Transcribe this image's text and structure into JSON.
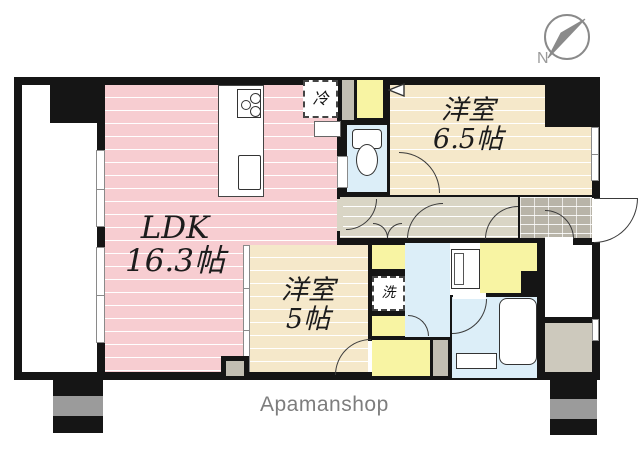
{
  "brand": "Apamanshop",
  "compass": {
    "label": "N"
  },
  "rooms": {
    "ldk": {
      "name": "LDK",
      "size": "16.3帖"
    },
    "bedroom_65": {
      "name": "洋室",
      "size": "6.5帖"
    },
    "bedroom_5": {
      "name": "洋室",
      "size": "5帖"
    }
  },
  "fixtures": {
    "refrigerator": "冷",
    "washing_machine": "洗"
  },
  "colors": {
    "ldk_floor": "#f7cdd1",
    "bedroom_floor": "#f5e8ca",
    "hallway_floor": "#d9d5c5",
    "entrance_tile": "#b8b4a8",
    "wet_area_floor": "#dceef8",
    "closet": "#f8f4a3",
    "pillar_gray": "#c2beb2",
    "wall": "#151515",
    "brand_text": "#7d7d7d",
    "compass_gray": "#8a8a8a"
  }
}
